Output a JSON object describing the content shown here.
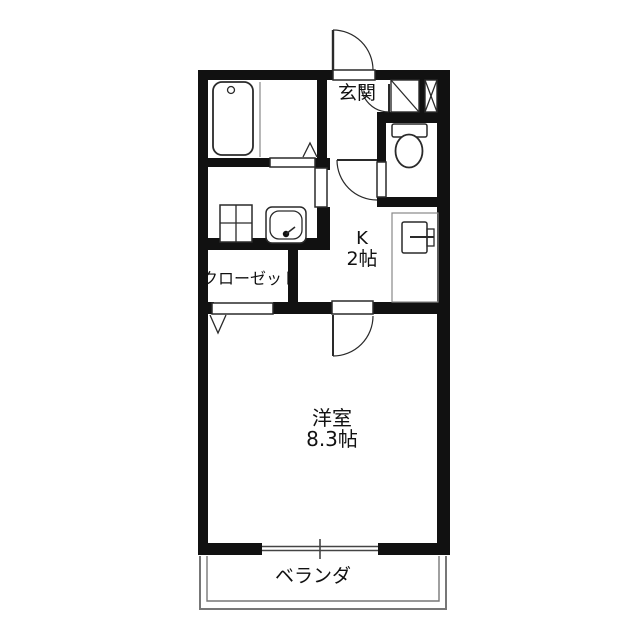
{
  "title": "apartment-floor-plan",
  "colors": {
    "wall": "#111111",
    "line": "#2a2a2a",
    "soft": "#888888",
    "veranda": "#777777",
    "bg": "#ffffff",
    "text": "#111111"
  },
  "rooms": {
    "entrance": {
      "label": "玄関"
    },
    "kitchen": {
      "label": "K",
      "size": "2帖"
    },
    "closet": {
      "label": "クローゼット"
    },
    "western_room": {
      "label": "洋室",
      "size": "8.3帖"
    },
    "veranda": {
      "label": "ベランダ"
    }
  },
  "fixtures": [
    "bathtub",
    "bath-partition",
    "toilet",
    "gas-stove",
    "kitchen-sink",
    "refrigerator-space",
    "shoe-cabinet",
    "pipe-space-x",
    "entrance-door-swing",
    "hall-door-swing",
    "toilet-door-swing",
    "room-door-swing",
    "folding-door-mark-bath",
    "folding-door-mark-closet",
    "sliding-window",
    "veranda-rail"
  ]
}
